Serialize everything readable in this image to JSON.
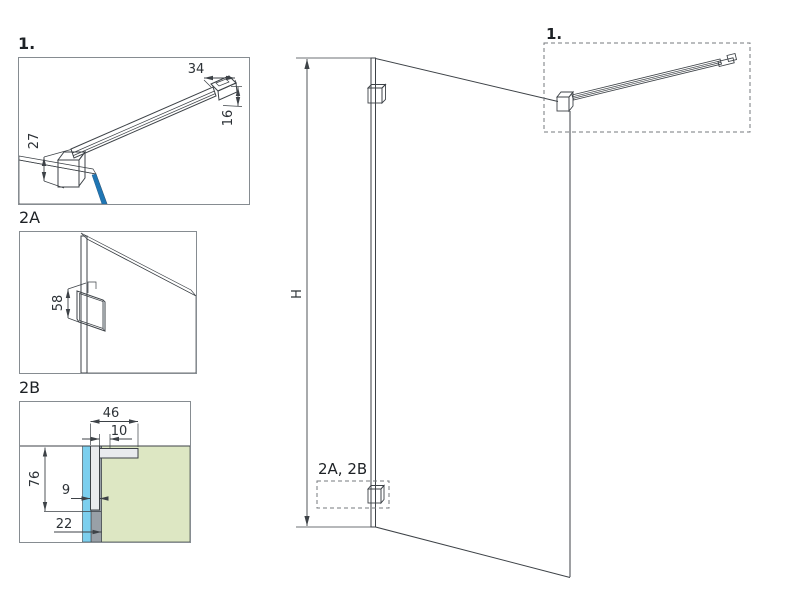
{
  "figure": {
    "detail1": {
      "label": "1.",
      "dim_bar_end_length": "34",
      "dim_bar_end_height": "16",
      "dim_bar_to_glass": "27"
    },
    "detail2a": {
      "label": "2A",
      "dim_bracket_height": "58"
    },
    "detail2b": {
      "label": "2B",
      "dim_profile_depth": "46",
      "dim_flange_width": "10",
      "dim_profile_height": "76",
      "dim_profile_thickness": "9",
      "dim_base_depth": "22"
    },
    "main_view": {
      "dim_height": "H",
      "callout_top": "1.",
      "callout_bottom": "2A, 2B"
    },
    "colors": {
      "line": "#3d4247",
      "dim_text": "#2c3136",
      "glass_blue": "#2b84c2",
      "glass_light": "#cfe9f7",
      "glass_cyan": "#7ccfee",
      "wall_green": "#dde7c3",
      "metal_light": "#e9ebee",
      "metal_shadow": "#c3c9ce",
      "metal_dark": "#99a0a7",
      "box_border": "#868c91"
    }
  }
}
